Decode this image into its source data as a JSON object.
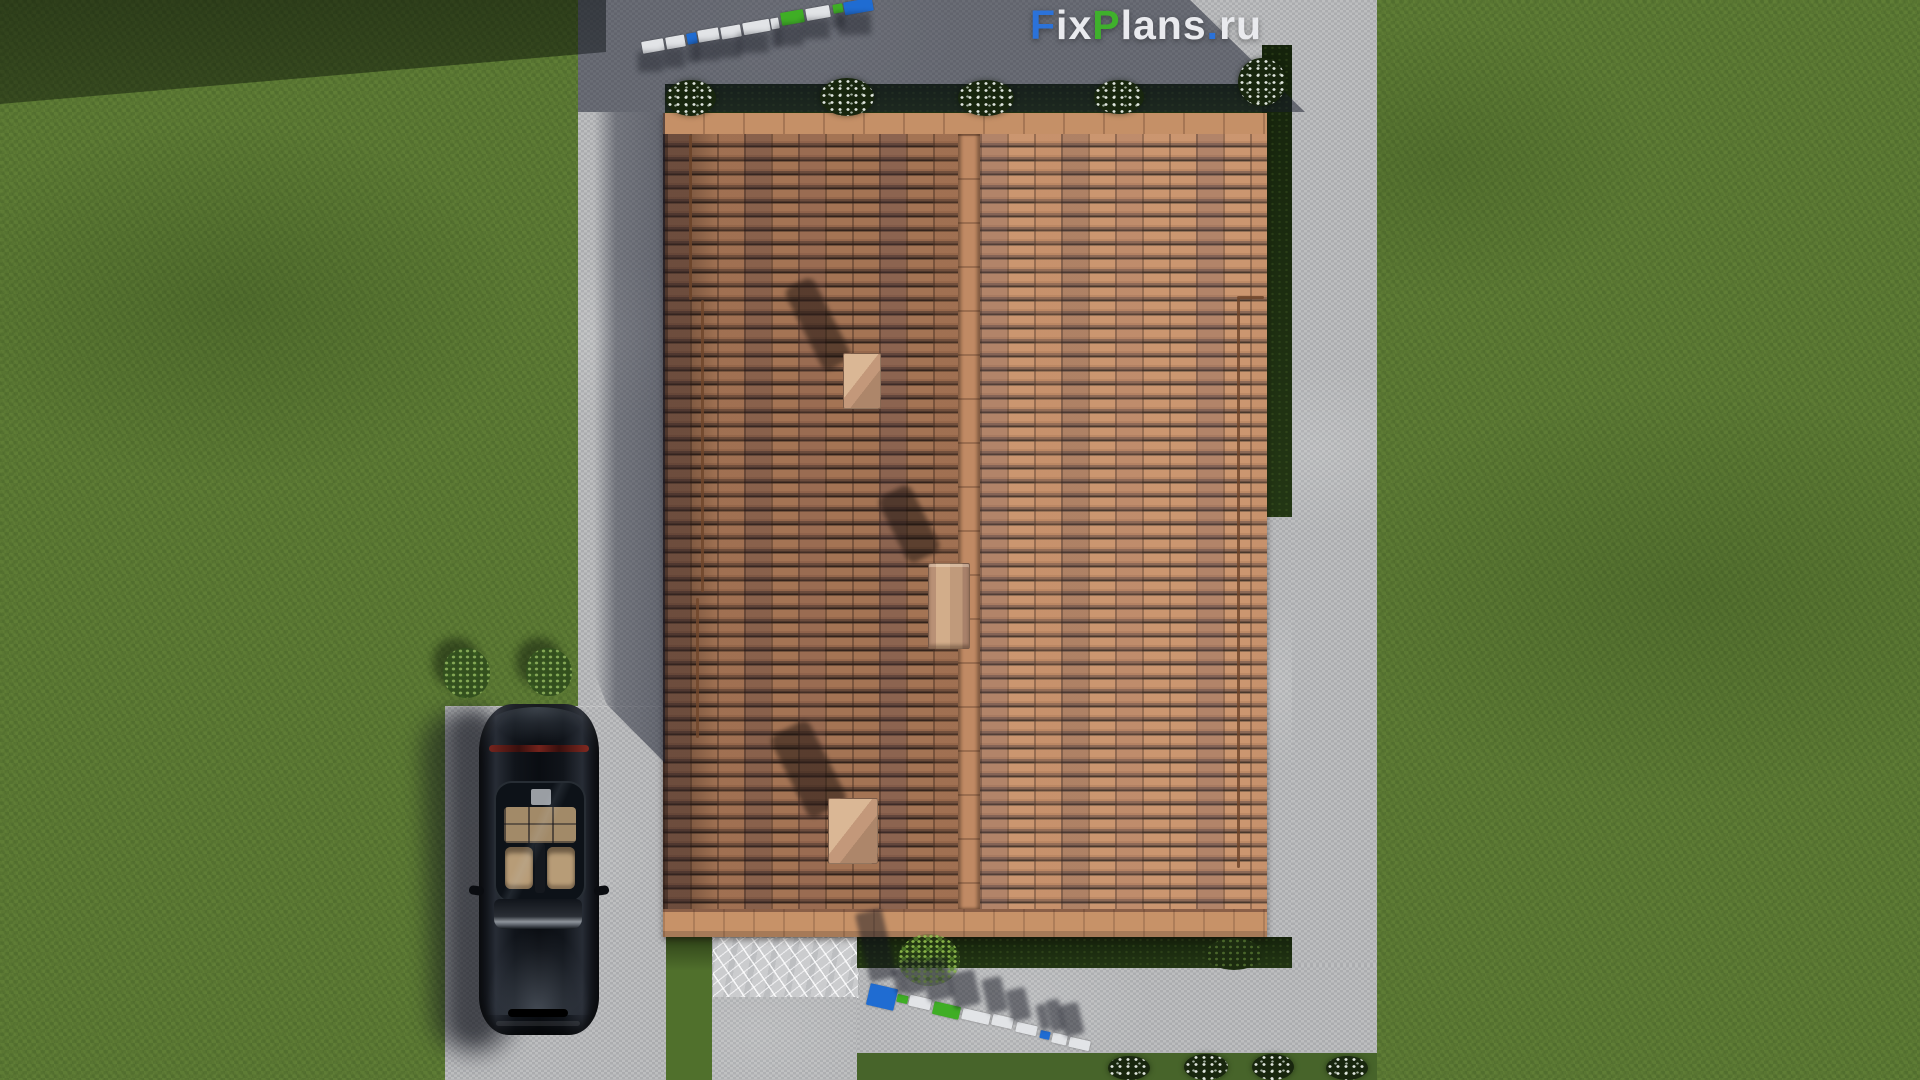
{
  "watermark": {
    "full_text": "FixPlans.ru",
    "parts": [
      {
        "text": "F",
        "color": "#2b72d9"
      },
      {
        "text": "ix",
        "color": "#e9eaee"
      },
      {
        "text": "P",
        "color": "#3fb02c"
      },
      {
        "text": "lans",
        "color": "#e9eaee"
      },
      {
        "text": ".",
        "color": "#2b72d9"
      },
      {
        "text": "ru",
        "color": "#e9eaee"
      }
    ]
  },
  "brand_colors": {
    "blue": "#1f6cd2",
    "green": "#3fae25",
    "white": "#e2e4e7"
  },
  "ground_logo_top": {
    "rotation_deg": -10,
    "blocks": [
      {
        "x": 642,
        "y": 40,
        "w": 22,
        "h": 12,
        "color": "#e2e4e7"
      },
      {
        "x": 666,
        "y": 36,
        "w": 19,
        "h": 12,
        "color": "#e2e4e7"
      },
      {
        "x": 687,
        "y": 33,
        "w": 10,
        "h": 11,
        "color": "#1f6cd2"
      },
      {
        "x": 698,
        "y": 29,
        "w": 21,
        "h": 12,
        "color": "#e2e4e7"
      },
      {
        "x": 721,
        "y": 26,
        "w": 20,
        "h": 12,
        "color": "#e2e4e7"
      },
      {
        "x": 743,
        "y": 21,
        "w": 27,
        "h": 12,
        "color": "#e2e4e7"
      },
      {
        "x": 771,
        "y": 18,
        "w": 8,
        "h": 11,
        "color": "#e2e4e7"
      },
      {
        "x": 781,
        "y": 11,
        "w": 23,
        "h": 13,
        "color": "#3fae25"
      },
      {
        "x": 806,
        "y": 7,
        "w": 24,
        "h": 12,
        "color": "#e2e4e7"
      },
      {
        "x": 833,
        "y": 4,
        "w": 10,
        "h": 9,
        "color": "#3fae25"
      },
      {
        "x": 844,
        "y": 0,
        "w": 29,
        "h": 13,
        "color": "#1f6cd2"
      }
    ]
  },
  "ground_logo_bottom": {
    "rotation_deg": 13,
    "blocks": [
      {
        "x": 868,
        "y": 986,
        "w": 28,
        "h": 22,
        "color": "#1f6cd2"
      },
      {
        "x": 897,
        "y": 995,
        "w": 11,
        "h": 8,
        "color": "#3fae25"
      },
      {
        "x": 909,
        "y": 997,
        "w": 22,
        "h": 11,
        "color": "#e2e4e7"
      },
      {
        "x": 933,
        "y": 1004,
        "w": 27,
        "h": 13,
        "color": "#3fae25"
      },
      {
        "x": 962,
        "y": 1011,
        "w": 28,
        "h": 11,
        "color": "#e2e4e7"
      },
      {
        "x": 992,
        "y": 1016,
        "w": 21,
        "h": 11,
        "color": "#e2e4e7"
      },
      {
        "x": 1016,
        "y": 1024,
        "w": 21,
        "h": 10,
        "color": "#e2e4e7"
      },
      {
        "x": 1040,
        "y": 1031,
        "w": 10,
        "h": 8,
        "color": "#1f6cd2"
      },
      {
        "x": 1052,
        "y": 1034,
        "w": 15,
        "h": 10,
        "color": "#e2e4e7"
      },
      {
        "x": 1069,
        "y": 1039,
        "w": 21,
        "h": 10,
        "color": "#e2e4e7"
      }
    ]
  },
  "roof": {
    "vents": [
      {
        "x": 843,
        "y": 353,
        "w": 36,
        "h": 54,
        "kind": "vent"
      },
      {
        "x": 928,
        "y": 563,
        "w": 40,
        "h": 84,
        "kind": "chimney"
      },
      {
        "x": 828,
        "y": 798,
        "w": 48,
        "h": 64,
        "kind": "vent"
      }
    ],
    "rails": [
      {
        "x": 689,
        "y": 135,
        "len": 165,
        "dir": "v"
      },
      {
        "x": 701,
        "y": 300,
        "len": 292,
        "dir": "v"
      },
      {
        "x": 696,
        "y": 598,
        "len": 140,
        "dir": "v"
      },
      {
        "x": 1237,
        "y": 298,
        "len": 570,
        "dir": "v"
      },
      {
        "x": 1237,
        "y": 296,
        "len": 27,
        "dir": "h"
      }
    ]
  },
  "vegetation": {
    "top_flower_bushes": [
      {
        "x": 666,
        "y": 80,
        "w": 50,
        "h": 36
      },
      {
        "x": 820,
        "y": 78,
        "w": 54,
        "h": 38
      },
      {
        "x": 958,
        "y": 80,
        "w": 56,
        "h": 36
      },
      {
        "x": 1094,
        "y": 80,
        "w": 50,
        "h": 34
      }
    ],
    "corner_flower_bush": {
      "x": 1238,
      "y": 58,
      "w": 48,
      "h": 48
    },
    "bottom_flower_bushes": [
      {
        "x": 1108,
        "y": 1056,
        "w": 42,
        "h": 24
      },
      {
        "x": 1184,
        "y": 1054,
        "w": 44,
        "h": 26
      },
      {
        "x": 1252,
        "y": 1054,
        "w": 42,
        "h": 26
      },
      {
        "x": 1326,
        "y": 1056,
        "w": 42,
        "h": 24
      }
    ],
    "left_green_bushes": [
      {
        "x": 443,
        "y": 648,
        "w": 47,
        "h": 50
      },
      {
        "x": 526,
        "y": 648,
        "w": 46,
        "h": 48
      }
    ],
    "weed_bush": {
      "x": 898,
      "y": 934,
      "w": 62,
      "h": 52
    },
    "bottom_garden_bush": {
      "x": 1206,
      "y": 938,
      "w": 56,
      "h": 32
    }
  }
}
